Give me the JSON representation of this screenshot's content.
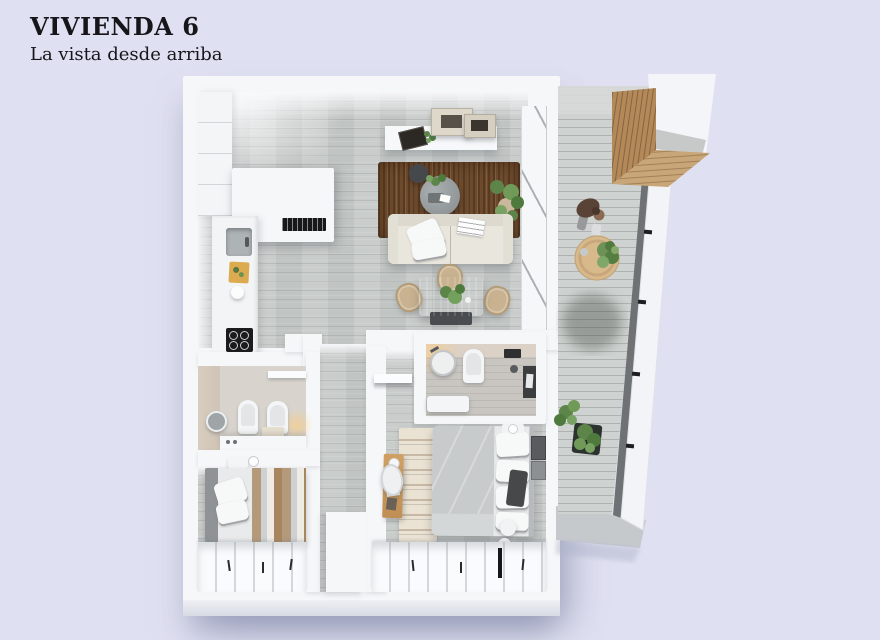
{
  "header": {
    "title": "VIVIENDA 6",
    "subtitle": "La vista desde arriba"
  },
  "palette": {
    "bg": "#dfe0f1",
    "wall": "#f6f7f9",
    "floor": "#c6cac8",
    "balcony-floor": "#ced2d0",
    "rug": "#6e4a2c",
    "wood": "#d5ad7a",
    "pergola-wood": "#b3895a",
    "sofa": "#e9e6dd",
    "appliance": "#1b1b1d",
    "tile": "#d5cabc",
    "duvet": "#c8cbcc",
    "stripe-tan": "#b49a7b",
    "railing": "#6e7274",
    "plant": "#5d8549",
    "title-ink": "#15151a"
  },
  "scene": {
    "type": "apartment-floor-plan-3d-top-view",
    "rooms": [
      {
        "name": "kitchen"
      },
      {
        "name": "living-dining-room"
      },
      {
        "name": "bathroom-1"
      },
      {
        "name": "bedroom-1"
      },
      {
        "name": "hallway"
      },
      {
        "name": "master-bedroom"
      },
      {
        "name": "ensuite-bathroom"
      },
      {
        "name": "balcony"
      }
    ],
    "furniture": [
      "kitchen-counter",
      "cooktop",
      "sink",
      "storage-box",
      "wall-shelf",
      "picture-frames",
      "area-rug",
      "coffee-tables",
      "sofa",
      "dining-table",
      "dining-chairs",
      "toilets",
      "vanity-mirror",
      "single-bed",
      "wardrobes",
      "double-bed",
      "desk",
      "desk-chair",
      "shower",
      "balcony-table",
      "pergola",
      "plants",
      "person"
    ]
  }
}
